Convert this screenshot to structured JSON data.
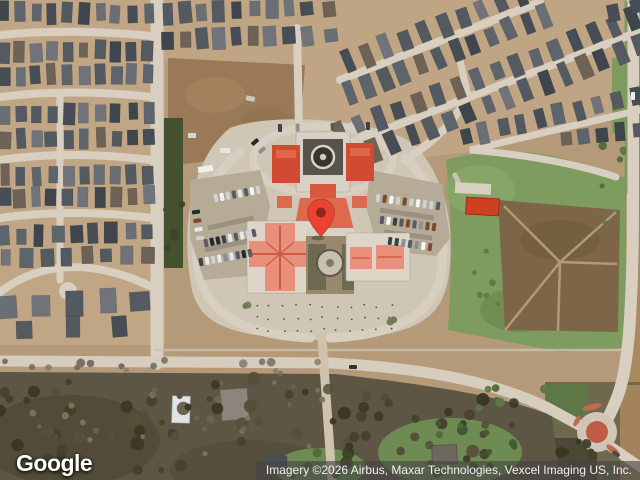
{
  "page": {
    "type": "satellite-map-view"
  },
  "marker": {
    "label": "dropped-pin",
    "fill": "#EA4335",
    "dot": "#8E271B",
    "tip_x": 321,
    "tip_y": 238
  },
  "map_colors": {
    "terrain_tan": "#b59a79",
    "road": "#d9cfc0",
    "school_roof_red": "#d14a31",
    "school_roof_salmon": "#e8907c",
    "field_green": "#7e9c5f",
    "woods_dark": "#5d5644",
    "roundabout_island": "#bf5b44"
  },
  "footer": {
    "logo_text": "Google",
    "attribution_text": "Imagery ©2026 Airbus, Maxar Technologies, Vexcel Imaging US, Inc."
  }
}
